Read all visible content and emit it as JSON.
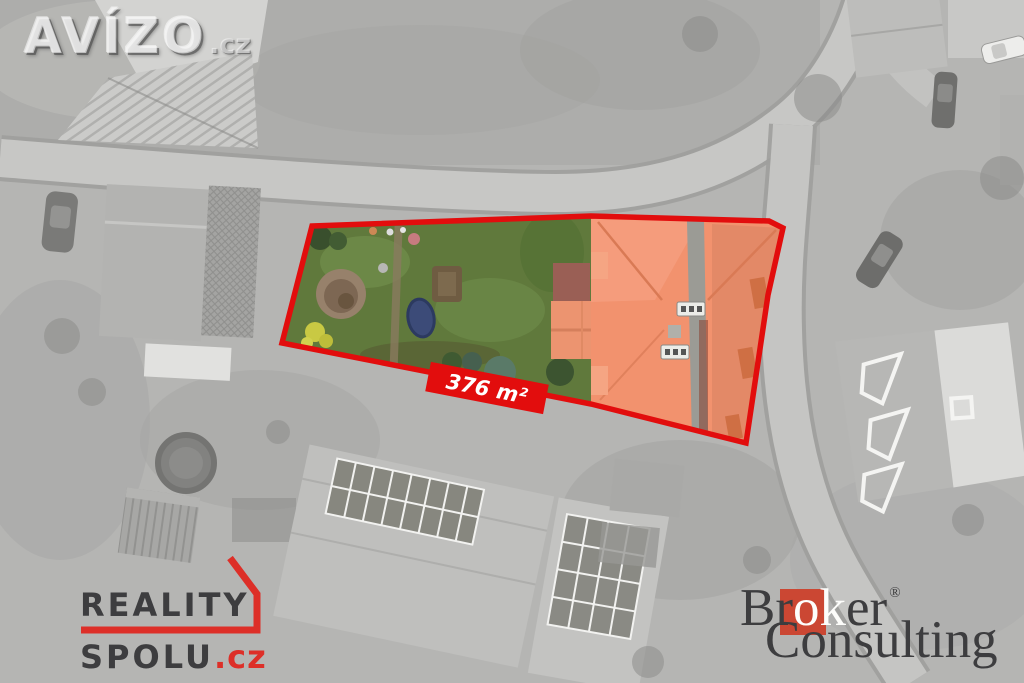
{
  "watermark": {
    "brand": "AVÍZO",
    "tld": ".cz"
  },
  "area_badge": {
    "label": "376 m²"
  },
  "reality_logo": {
    "line1": "REALITY",
    "line2": "SPOLU",
    "tld": ".cz"
  },
  "broker_logo": {
    "b": "B",
    "r": "r",
    "ok": "ok",
    "er": "er",
    "reg": "®",
    "line2": "Consulting"
  },
  "colors": {
    "parcel-red": "#e20d0d",
    "roof-orange": "#f2926e",
    "garden-green": "#60793c",
    "reality-red": "#dd2f28",
    "broker-red": "#cb4733",
    "text-dark": "#3d3d3f"
  }
}
